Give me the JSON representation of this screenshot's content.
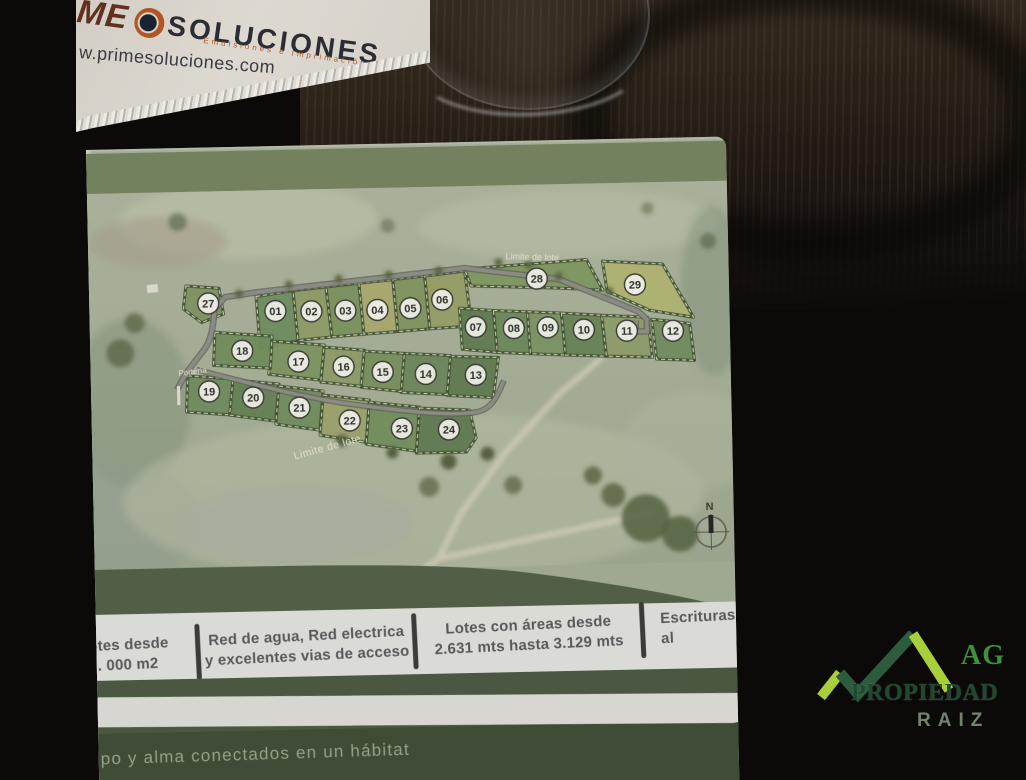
{
  "photo": {
    "card": {
      "brand_fragment": "ME",
      "brand_main": "SOLUCIONES.",
      "subtitle": "Emulsiones e Imprimación",
      "website": "w.primesoluciones.com",
      "accent_color": "#b35422"
    },
    "realtor_logo": {
      "line1": "AG",
      "line2": "PROPIEDAD",
      "line3": "RAIZ",
      "light_green": "#a8cf3a",
      "dark_green": "#2c5c3d"
    }
  },
  "brochure": {
    "colors": {
      "page_band_green": "#74815f",
      "footer_green": "#4a5741",
      "terrain": "#a5ad97",
      "road": "#7d7f76",
      "sand_path": "#cfc9b2"
    },
    "map": {
      "boundary_label_top": "Limite de lote",
      "boundary_label_bottom": "Limite de lote",
      "gate_label": "Portería",
      "compass_north": "N",
      "lots": [
        {
          "num": "01",
          "x": 186,
          "y": 121,
          "points": "167,106 204,101 208,151 170,158",
          "fill": "#6d8a5e"
        },
        {
          "num": "02",
          "x": 222,
          "y": 122,
          "points": "204,101 237,98 242,148 208,151",
          "fill": "#8b9a65"
        },
        {
          "num": "03",
          "x": 256,
          "y": 122,
          "points": "237,98 270,95 274,146 242,148",
          "fill": "#79905d"
        },
        {
          "num": "04",
          "x": 288,
          "y": 122,
          "points": "270,95 304,92 308,144 274,146",
          "fill": "#a9a76c"
        },
        {
          "num": "05",
          "x": 321,
          "y": 121,
          "points": "304,92 336,89 340,142 308,144",
          "fill": "#7e925e"
        },
        {
          "num": "06",
          "x": 353,
          "y": 113,
          "points": "336,89 376,85 382,140 340,142",
          "fill": "#949c64"
        },
        {
          "num": "07",
          "x": 386,
          "y": 141,
          "points": "370,122 404,125 407,167 372,163",
          "fill": "#5e7950"
        },
        {
          "num": "08",
          "x": 424,
          "y": 143,
          "points": "404,125 438,127 440,169 407,167",
          "fill": "#6b865b"
        },
        {
          "num": "09",
          "x": 458,
          "y": 143,
          "points": "438,127 472,129 475,171 440,169",
          "fill": "#7b9161"
        },
        {
          "num": "10",
          "x": 494,
          "y": 146,
          "points": "472,129 512,132 516,173 475,171",
          "fill": "#667f54"
        },
        {
          "num": "11",
          "x": 537,
          "y": 148,
          "points": "512,132 558,135 562,175 516,173",
          "fill": "#8b9b67"
        },
        {
          "num": "12",
          "x": 583,
          "y": 149,
          "points": "562,137 600,142 604,179 566,177",
          "fill": "#6e8a5e"
        },
        {
          "num": "13",
          "x": 385,
          "y": 189,
          "points": "360,170 408,172 402,212 356,209",
          "fill": "#5e784f"
        },
        {
          "num": "14",
          "x": 335,
          "y": 187,
          "points": "314,166 360,169 356,208 310,205",
          "fill": "#6a8459"
        },
        {
          "num": "15",
          "x": 292,
          "y": 184,
          "points": "274,163 314,166 310,204 270,199",
          "fill": "#758d5a"
        },
        {
          "num": "16",
          "x": 253,
          "y": 178,
          "points": "234,158 274,162 270,198 230,193",
          "fill": "#8a9a65"
        },
        {
          "num": "17",
          "x": 208,
          "y": 172,
          "points": "182,151 234,156 230,191 178,184",
          "fill": "#7c925f"
        },
        {
          "num": "18",
          "x": 152,
          "y": 160,
          "points": "125,141 182,146 180,178 123,174",
          "fill": "#6f8a5b"
        },
        {
          "num": "19",
          "x": 118,
          "y": 200,
          "points": "97,184 142,188 140,224 95,220",
          "fill": "#6e895d"
        },
        {
          "num": "20",
          "x": 162,
          "y": 207,
          "points": "142,189 188,194 184,231 138,224",
          "fill": "#637e53"
        },
        {
          "num": "21",
          "x": 208,
          "y": 218,
          "points": "188,196 232,202 228,241 184,234",
          "fill": "#6e8a5b"
        },
        {
          "num": "22",
          "x": 258,
          "y": 232,
          "points": "232,206 278,212 274,254 228,246",
          "fill": "#9aa069"
        },
        {
          "num": "23",
          "x": 310,
          "y": 241,
          "points": "278,214 328,220 324,264 274,256",
          "fill": "#6f8b5a"
        },
        {
          "num": "24",
          "x": 357,
          "y": 243,
          "points": "328,221 378,224 384,252 374,266 324,266",
          "fill": "#5e784f"
        },
        {
          "num": "27",
          "x": 119,
          "y": 112,
          "points": "97,94 130,97 134,123 112,131 94,117",
          "fill": "#7e915f"
        },
        {
          "num": "28",
          "x": 448,
          "y": 94,
          "points": "376,83 498,76 514,107 470,104 382,100",
          "fill": "#7c955f"
        },
        {
          "num": "29",
          "x": 546,
          "y": 102,
          "points": "514,78 574,82 604,136 560,128 518,108",
          "fill": "#aeb16f"
        }
      ]
    },
    "features": [
      {
        "line1": "otes desde",
        "line2": "0. 000 m2"
      },
      {
        "line1": "Red de agua, Red electrica",
        "line2": "y excelentes vias de acceso"
      },
      {
        "line1": "Lotes con áreas desde",
        "line2": "2.631 mts hasta 3.129 mts"
      },
      {
        "line1": "Escrituras al",
        "line2": ""
      }
    ],
    "tagline": "po y alma conectados en un hábitat"
  }
}
